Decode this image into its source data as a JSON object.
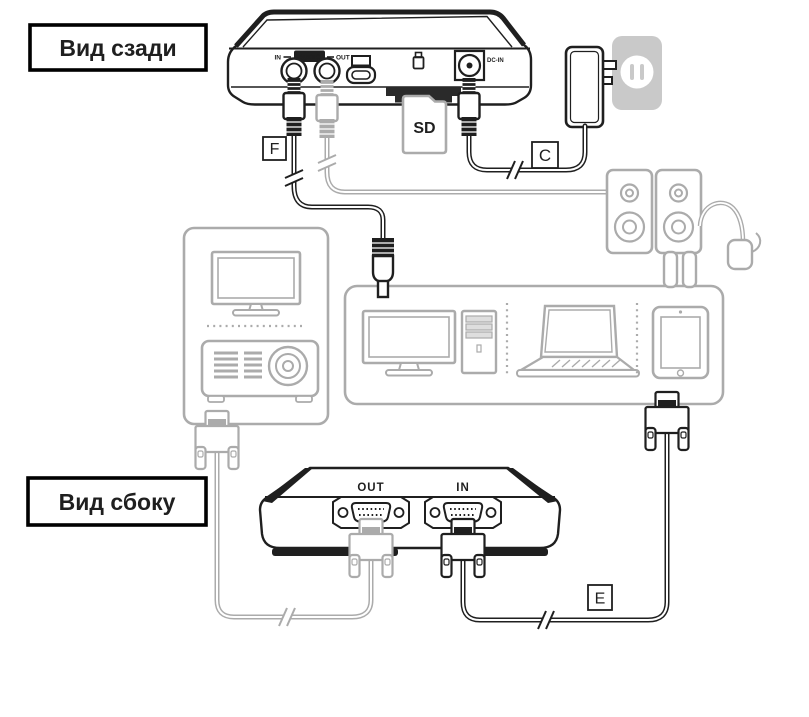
{
  "view_labels": {
    "rear": "Вид сзади",
    "side": "Вид сбоку"
  },
  "cable_tags": {
    "f": "F",
    "c": "C",
    "e": "E"
  },
  "rear_panel": {
    "audio_in": "IN",
    "audio": "AUDIO",
    "audio_out": "OUT",
    "dc_in": "DC-IN"
  },
  "sd_card": {
    "label": "SD"
  },
  "side_panel": {
    "out": "OUT",
    "in": "IN"
  },
  "colors": {
    "ink": "#1f1f1f",
    "gray": "#ababab",
    "outlet_gray": "#c9c9c9"
  },
  "icons": {
    "display_port": "display-icon",
    "usb_device": "usb-device-icon",
    "sd_slot": "sd-slot-icon"
  }
}
